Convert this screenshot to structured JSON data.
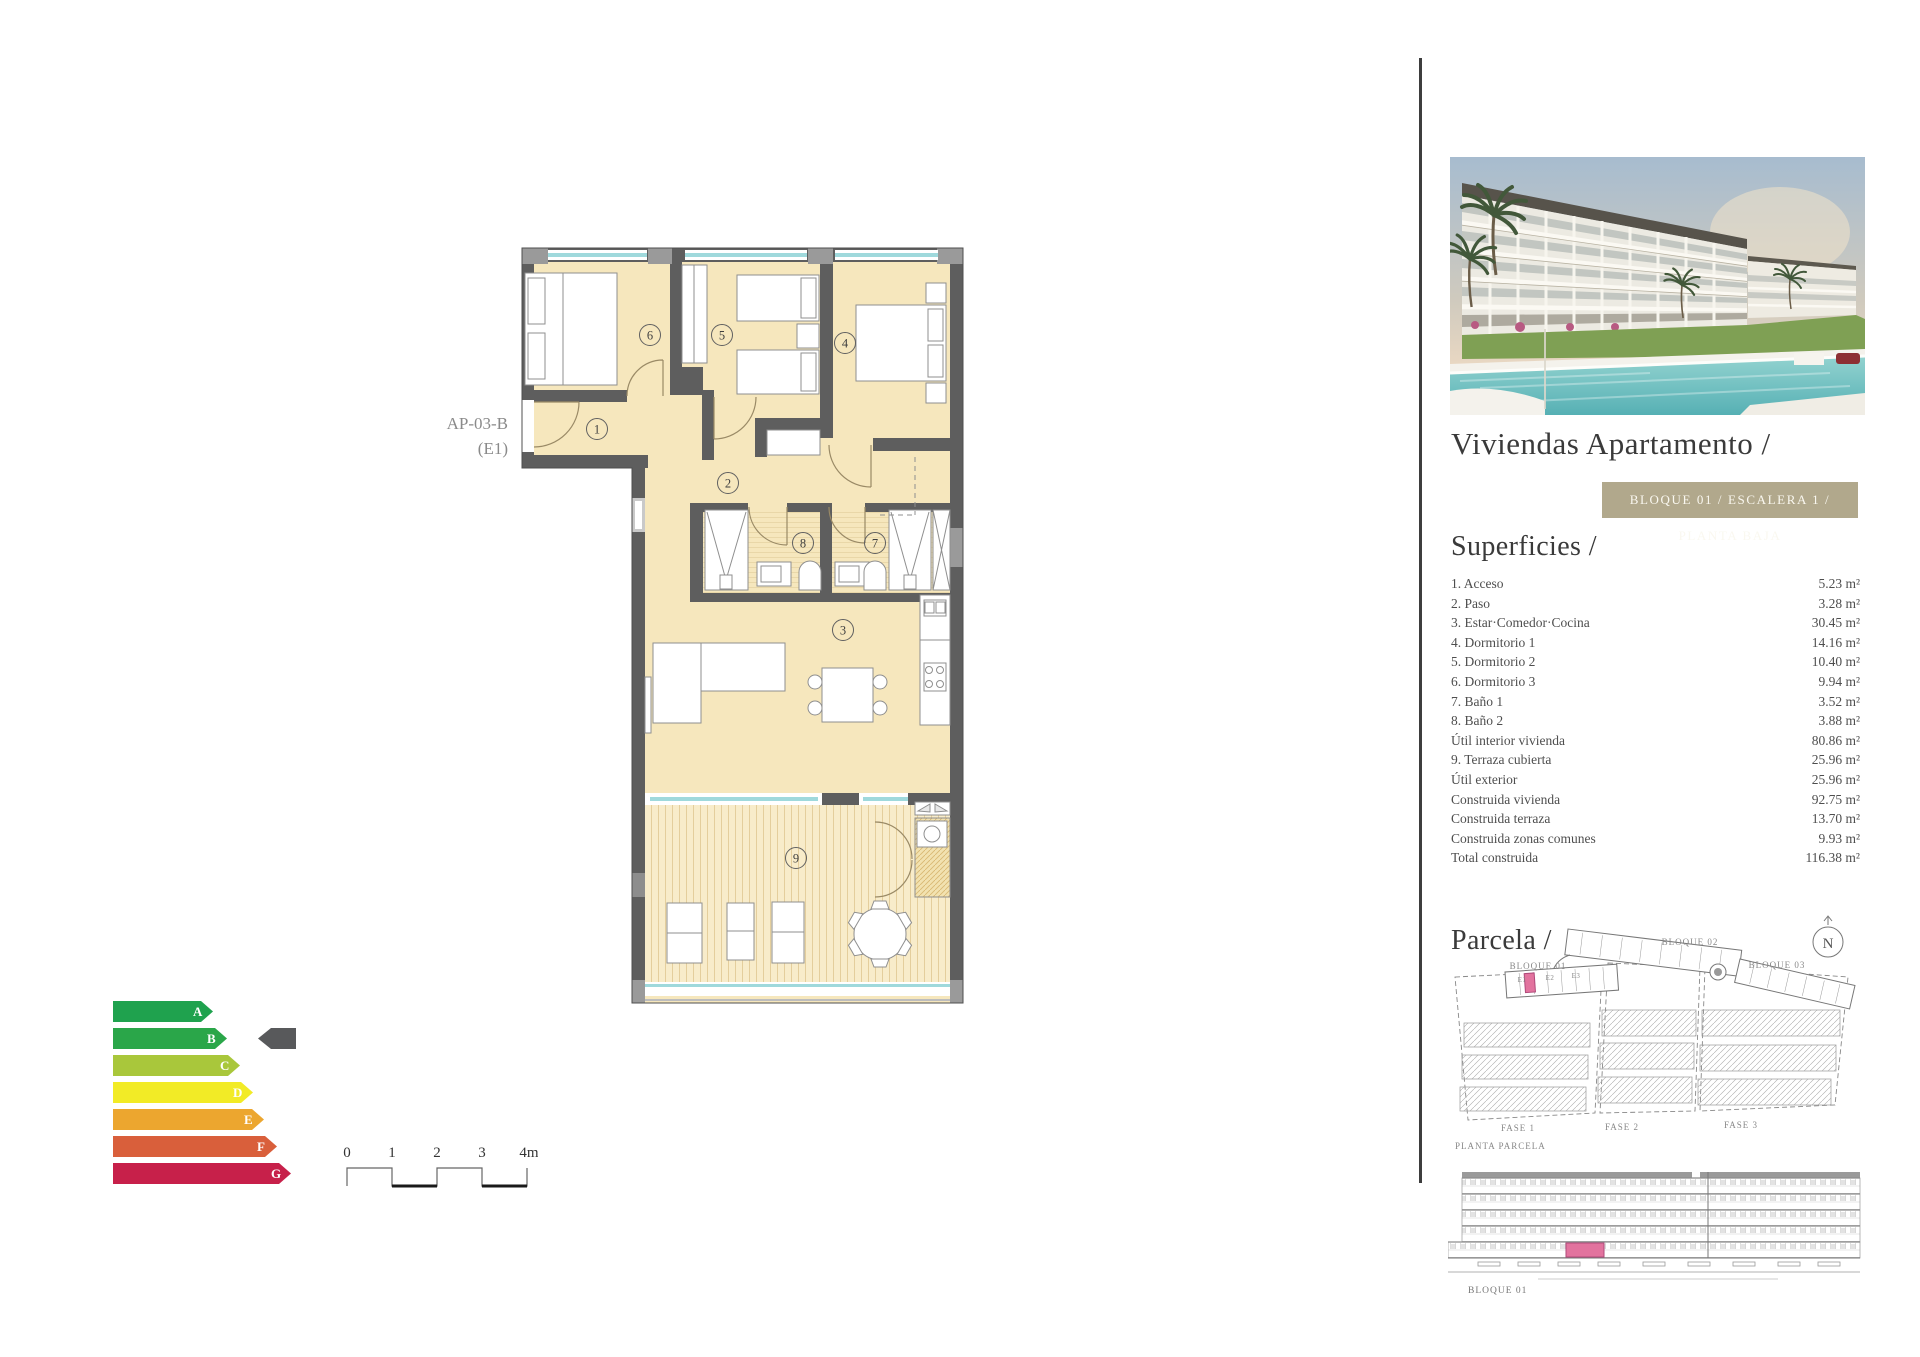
{
  "floor_plan": {
    "unit_label": "AP-03-B",
    "unit_variant": "(E1)",
    "room_numbers": [
      "1",
      "2",
      "3",
      "4",
      "5",
      "6",
      "7",
      "8",
      "9"
    ],
    "colors": {
      "floor": "#f6e7bd",
      "wall": "#5e5e5e",
      "glass": "#9fd9dc",
      "highlight": "#e2739e"
    }
  },
  "energy_label": {
    "selected": "B",
    "arrow_color": "#58595b",
    "ratings": [
      {
        "letter": "A",
        "color": "#1fa24e"
      },
      {
        "letter": "B",
        "color": "#2aa649"
      },
      {
        "letter": "C",
        "color": "#a9c73b"
      },
      {
        "letter": "D",
        "color": "#f2eb26"
      },
      {
        "letter": "E",
        "color": "#eca62f"
      },
      {
        "letter": "F",
        "color": "#d95f3b"
      },
      {
        "letter": "G",
        "color": "#c7204a"
      }
    ]
  },
  "scale_bar": {
    "labels": [
      "0",
      "1",
      "2",
      "3",
      "4m"
    ]
  },
  "sidebar": {
    "title": "Viviendas Apartamento /",
    "badge": "BLOQUE 01 / ESCALERA 1 / PLANTA BAJA",
    "badge_bg": "#b1a88c",
    "superficies": {
      "heading": "Superficies /",
      "items": [
        {
          "label": "1. Acceso",
          "value": "5.23 m²"
        },
        {
          "label": "2. Paso",
          "value": "3.28 m²"
        },
        {
          "label": "3. Estar·Comedor·Cocina",
          "value": "30.45 m²"
        },
        {
          "label": "4. Dormitorio 1",
          "value": "14.16 m²"
        },
        {
          "label": "5. Dormitorio 2",
          "value": "10.40 m²"
        },
        {
          "label": "6. Dormitorio 3",
          "value": "9.94 m²"
        },
        {
          "label": "7. Baño 1",
          "value": "3.52 m²"
        },
        {
          "label": "8. Baño 2",
          "value": "3.88 m²"
        },
        {
          "label": "Útil interior vivienda",
          "value": "80.86 m²"
        },
        {
          "label": "9. Terraza cubierta",
          "value": "25.96 m²"
        },
        {
          "label": "Útil exterior",
          "value": "25.96 m²"
        },
        {
          "label": "Construida vivienda",
          "value": "92.75 m²"
        },
        {
          "label": "Construida terraza",
          "value": "13.70 m²"
        },
        {
          "label": "Construida zonas comunes",
          "value": "9.93 m²"
        },
        {
          "label": "Total construida",
          "value": "116.38 m²"
        }
      ]
    },
    "parcela": {
      "heading": "Parcela /",
      "north": "N",
      "bloques": [
        "BLOQUE 01",
        "BLOQUE 02",
        "BLOQUE 03"
      ],
      "escaleras": [
        "E1",
        "E2",
        "E3"
      ],
      "fases": [
        "FASE 1",
        "FASE 2",
        "FASE 3"
      ],
      "caption": "PLANTA PARCELA",
      "highlight": "#e2739e"
    },
    "elevation": {
      "label": "BLOQUE 01",
      "highlight": "#e2739e"
    }
  }
}
